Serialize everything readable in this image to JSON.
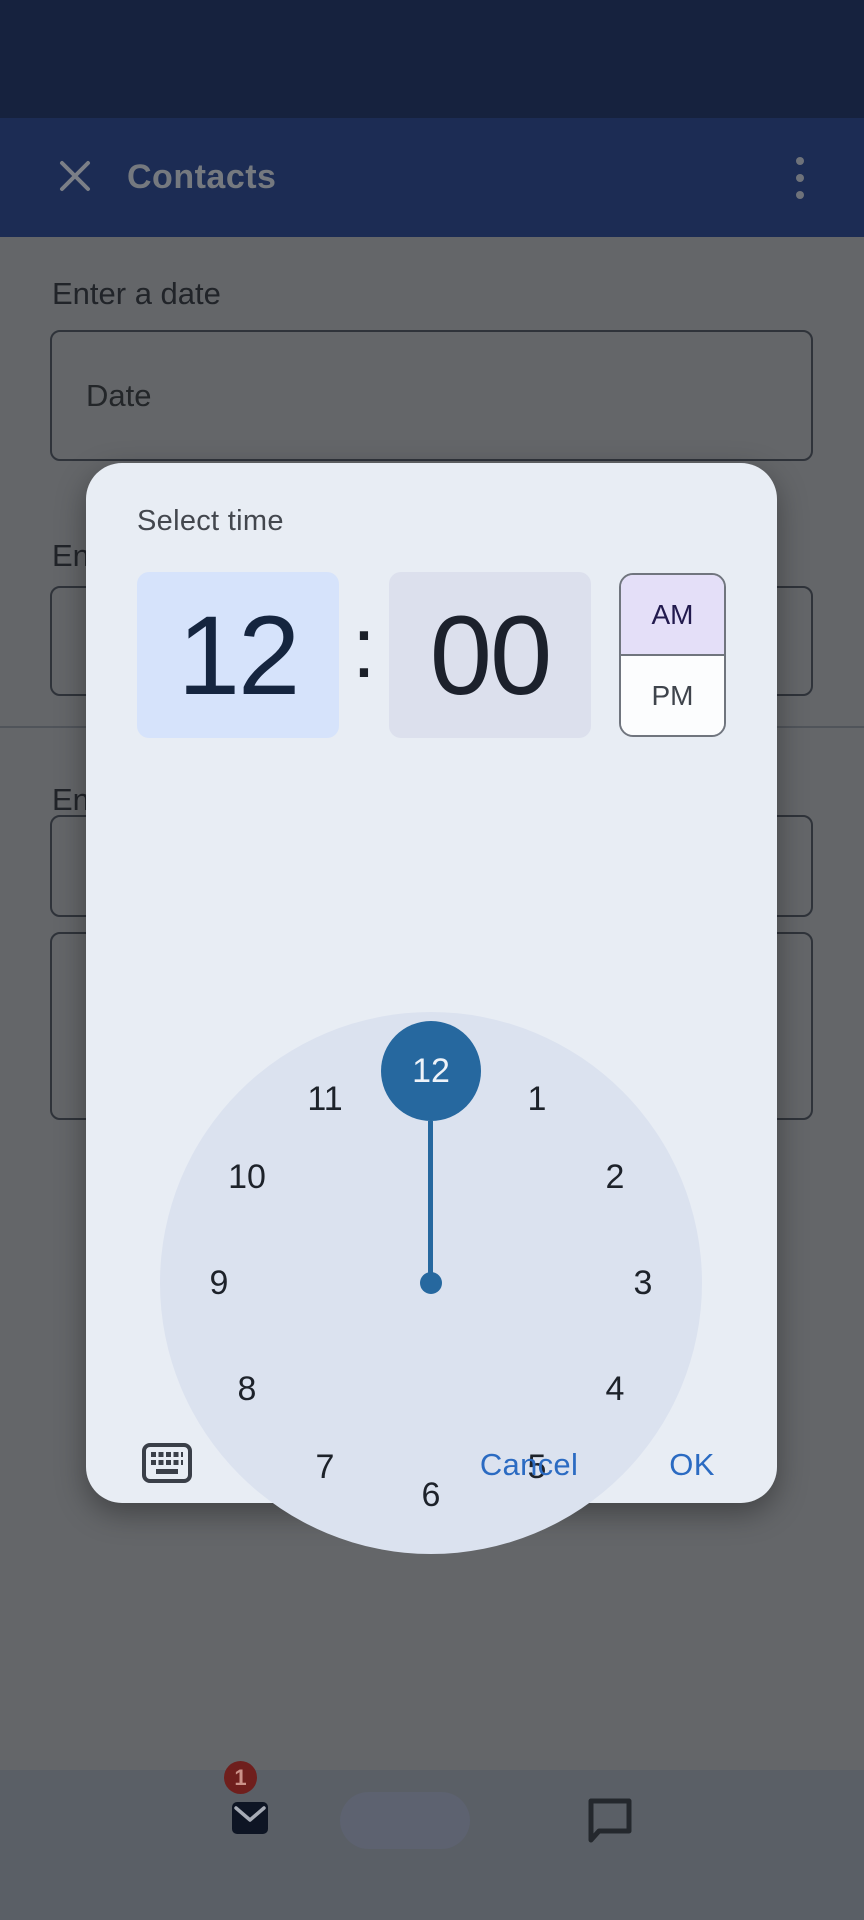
{
  "app_bar": {
    "title": "Contacts"
  },
  "form": {
    "date_label": "Enter a date",
    "date_placeholder": "Date",
    "partial_label_top": "En",
    "partial_label_bottom": "En"
  },
  "dialog": {
    "title": "Select time",
    "time": {
      "hour": "12",
      "separator": ":",
      "minute": "00"
    },
    "period": {
      "am": "AM",
      "pm": "PM",
      "selected": "AM"
    },
    "clock": {
      "numbers": [
        "12",
        "1",
        "2",
        "3",
        "4",
        "5",
        "6",
        "7",
        "8",
        "9",
        "10",
        "11"
      ],
      "selected": "12"
    },
    "actions": {
      "cancel": "Cancel",
      "ok": "OK"
    }
  },
  "bottom_nav": {
    "mail_badge_count": "1"
  },
  "colors": {
    "status_bar_bg": "#16223e",
    "app_bar_bg": "#1c2c54",
    "dialog_bg": "#e8edf4",
    "hour_box_bg": "#d6e3fb",
    "minute_box_bg": "#dce0ed",
    "am_selected_bg": "#e4dff8",
    "clock_face_bg": "#dbe2ef",
    "clock_accent_blue": "#26689f",
    "action_blue": "#2b6bc2",
    "badge_red": "#6f1f1d"
  }
}
